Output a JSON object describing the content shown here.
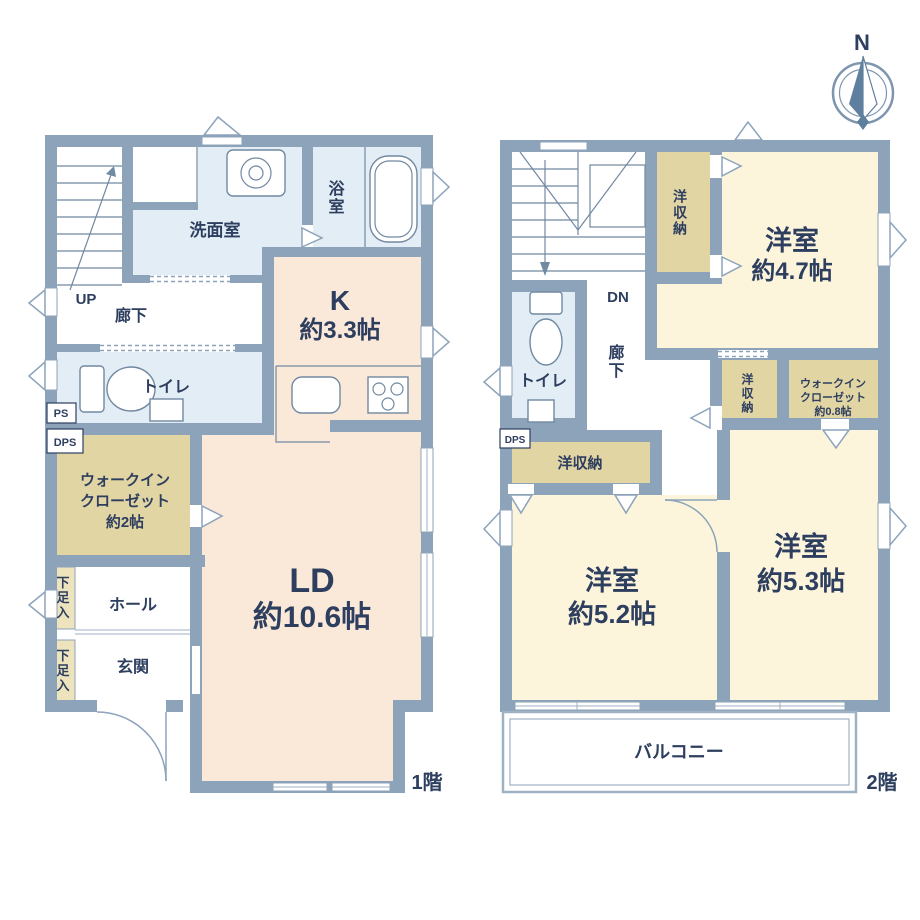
{
  "colors": {
    "wall": "#8CA3BA",
    "outline": "#5E7590",
    "text": "#2D3E5F",
    "ldk_fill": "#FAE8D9",
    "bedroom_fill": "#FCF5DB",
    "closet_fill": "#E2D5A4",
    "shoe_box_fill": "#EDE3BD",
    "water_fill": "#E3EDF5"
  },
  "compass": {
    "north_label": "N"
  },
  "floor1": {
    "floor_label": "1階",
    "stairs_direction": "UP",
    "shafts": {
      "ps": "PS",
      "dps": "DPS"
    },
    "rooms": {
      "washroom": "洗面室",
      "bathroom": "浴室",
      "kitchen": {
        "name": "K",
        "size": "約3.3帖"
      },
      "living_dining": {
        "name": "LD",
        "size": "約10.6帖"
      },
      "hallway": "廊下",
      "toilet": "トイレ",
      "walk_in_closet": {
        "line1": "ウォークイン",
        "line2": "クローゼット",
        "line3": "約2帖"
      },
      "shoe_box_upper": "下足入",
      "shoe_box_lower": "下足入",
      "hall": "ホール",
      "entrance": "玄関"
    }
  },
  "floor2": {
    "floor_label": "2階",
    "stairs_direction": "DN",
    "shafts": {
      "dps": "DPS"
    },
    "rooms": {
      "hallway": "廊下",
      "toilet": "トイレ",
      "closet_top": "洋収納",
      "closet_mid": "洋収納",
      "closet_low": "洋収納",
      "walk_in_closet": {
        "line1": "ウォークイン",
        "line2": "クローゼット",
        "line3": "約0.8帖"
      },
      "bedroom_47": {
        "name": "洋室",
        "size": "約4.7帖"
      },
      "bedroom_52": {
        "name": "洋室",
        "size": "約5.2帖"
      },
      "bedroom_53": {
        "name": "洋室",
        "size": "約5.3帖"
      },
      "balcony": "バルコニー"
    }
  }
}
